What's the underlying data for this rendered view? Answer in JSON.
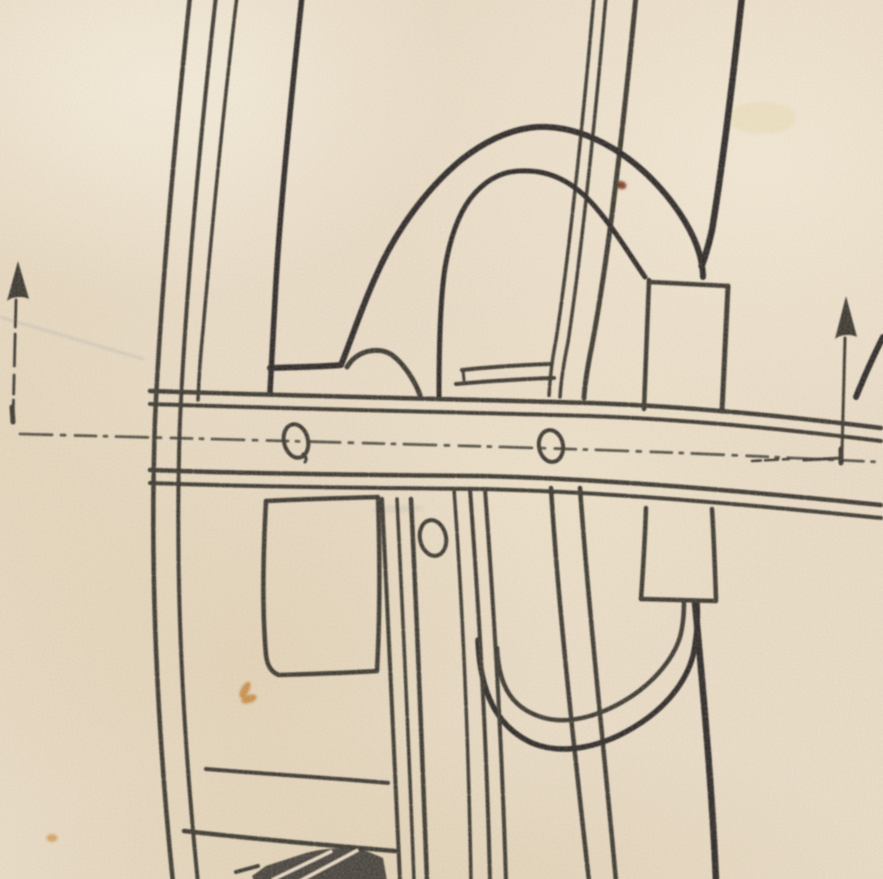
{
  "document": {
    "kind": "scanned-technical-line-drawing",
    "visible_text": []
  },
  "colors": {
    "paper": "#eadcc6",
    "paper_light": "#f3ebdb",
    "paper_shadow": "#d9c8a9",
    "ink": "#34312b",
    "ink_heavy": "#272420",
    "pencil": "#8d97a8",
    "stain_orange": "#c07a2e",
    "stain_orange_light": "#cf9045",
    "stain_red": "#70290f",
    "stain_soft": "#e8d9ad"
  },
  "labels": {
    "drawing": "vintage structural drawing detail",
    "rib": "curved rib",
    "brace_left": "left diagonal member",
    "kingpost": "central strut",
    "brace_right": "right diagonal brace",
    "arch_bracket": "arch bracket",
    "packing_plate": "packing plate",
    "block_upper": "upper filler block",
    "cross_bar": "horizontal cross bar",
    "rivet_hole_left": "rivet hole",
    "rivet_hole_center": "rivet hole",
    "rivet_hole_lower": "rivet hole",
    "u_strap": "u-strap fitting",
    "block_lower": "lower filler block",
    "web_panel": "web panel",
    "member_left": "left vertical member",
    "member_right": "right vertical member",
    "rungs": "cross rungs",
    "bottom_fitting": "bottom fitting",
    "arrow_left": "up arrow",
    "arrow_right": "up arrow",
    "tick_right": "diagonal tick",
    "pencil_line": "pencil guideline",
    "stains": "paper stains"
  }
}
